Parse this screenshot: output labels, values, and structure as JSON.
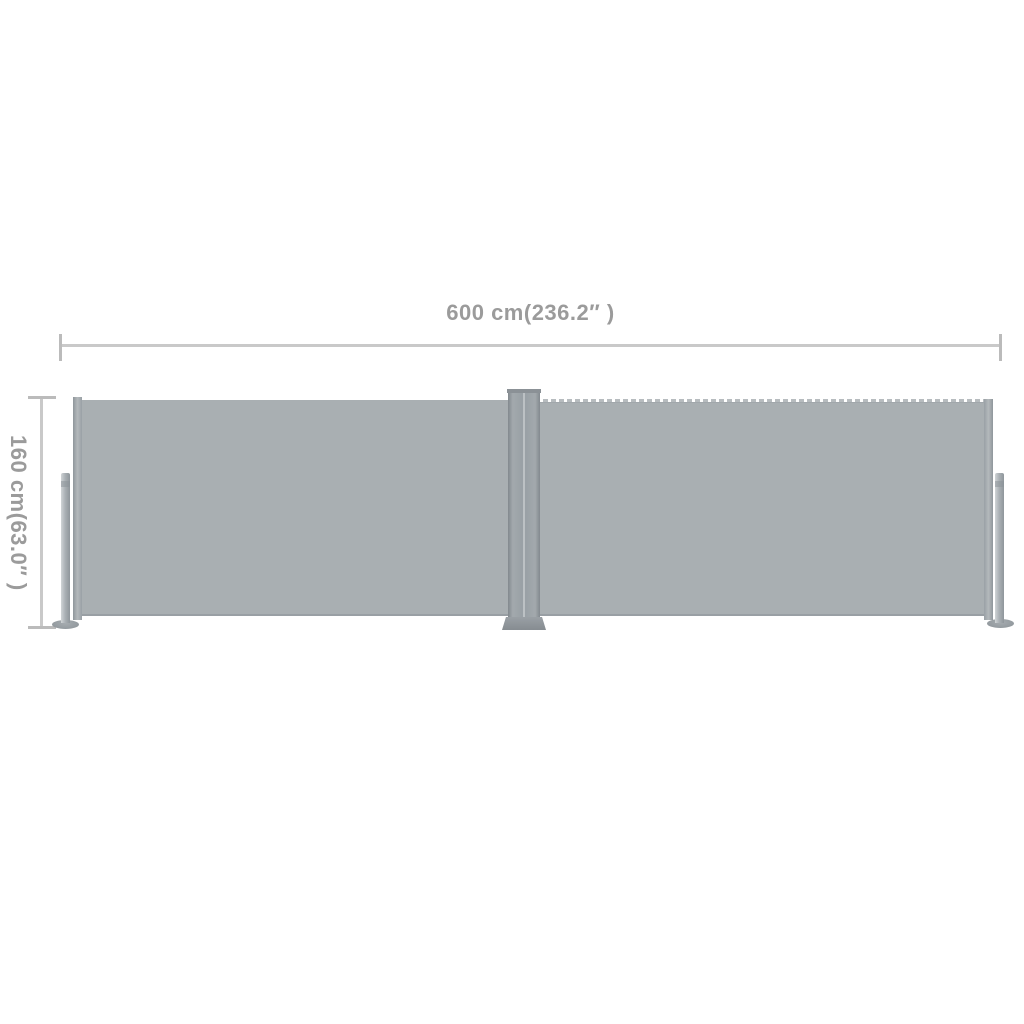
{
  "diagram": {
    "width_dimension_label": "600 cm(236.2″ )",
    "height_dimension_label": "160 cm(63.0″ )",
    "colors": {
      "background": "#ffffff",
      "fabric": "#a9afb2",
      "frame_metal": "#99a0a5",
      "pole_highlight": "#d0d4d6",
      "dimension_line": "#c9c9c9",
      "dimension_text": "#9b9b9b"
    }
  }
}
